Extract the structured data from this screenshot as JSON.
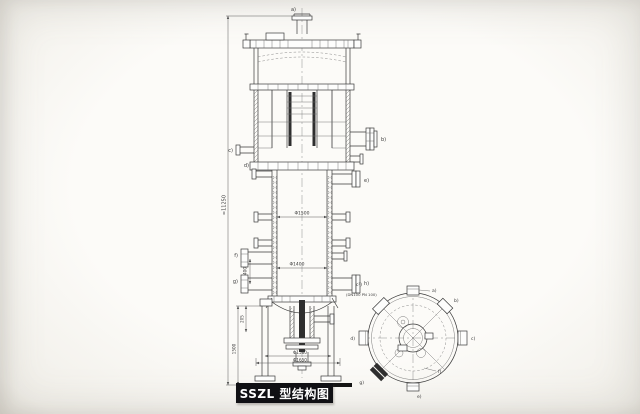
{
  "colors": {
    "ink": "#3a3a3a",
    "paper": "#f9f8f5",
    "title_bg": "#101014",
    "title_fg": "#ffffff"
  },
  "title_box": {
    "text": "SSZL 型结构图"
  },
  "elevation": {
    "nozzle_labels": {
      "a": "a)",
      "b": "b)",
      "c": "c)",
      "d": "d)",
      "e": "e)",
      "f": "f)",
      "g": "g)",
      "h": "h)"
    },
    "dims": {
      "overall_height": "≈11250",
      "shell_inner_dia": "Φ1500",
      "lower_inner_dia": "Φ1400",
      "base_bolt_circle": "Φ1580",
      "base_outer_circle": "Φ1650",
      "leg_height": "1500",
      "bottom_clearance": "205",
      "nozzle_spacing": "400"
    }
  },
  "plan": {
    "note_label": "c²)",
    "note_text": "(DN100 PN 100)",
    "nozzle_labels": {
      "a": "a)",
      "b": "b)",
      "c": "c)",
      "d": "d)",
      "e": "e)",
      "f": "f)",
      "g": "g)"
    }
  }
}
